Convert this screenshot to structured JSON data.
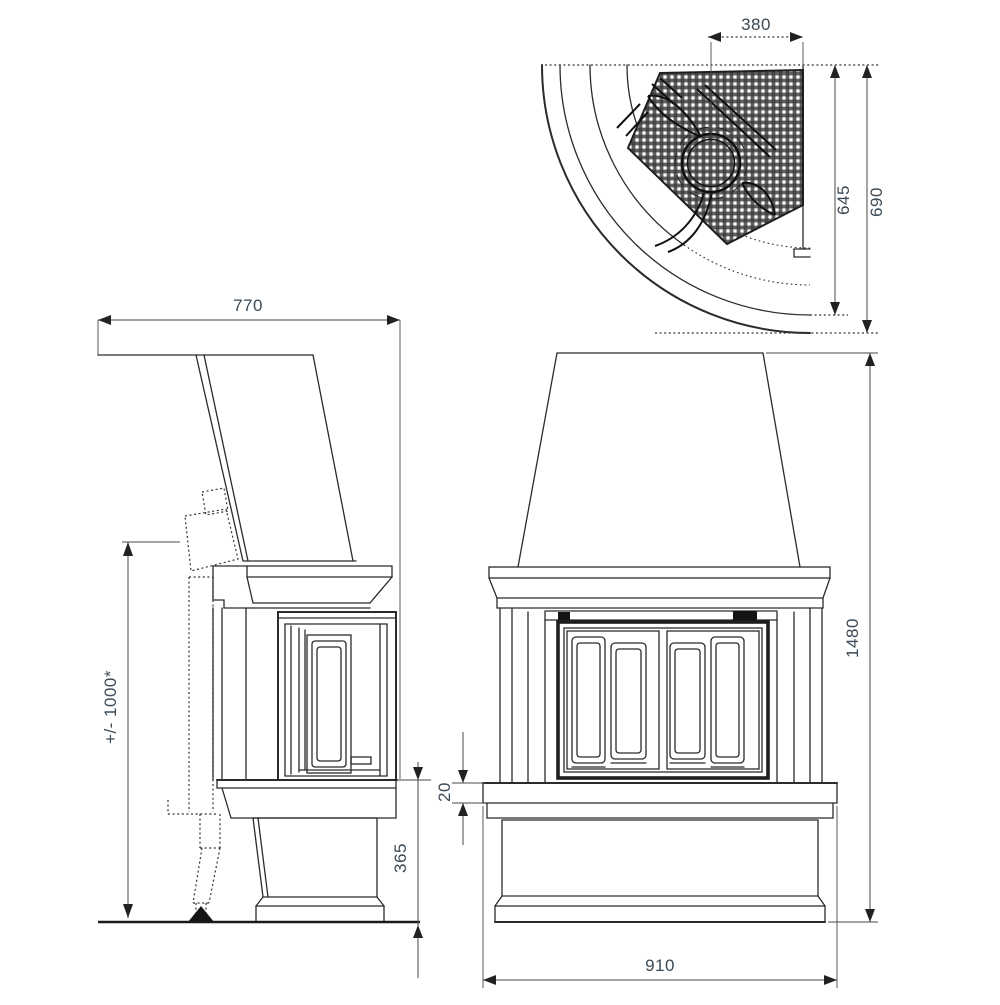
{
  "drawing": {
    "kind": "fireplace-three-view-technical-drawing",
    "views": [
      {
        "id": "top",
        "name": "plan view (curved front, flue section hatched)"
      },
      {
        "id": "side",
        "name": "side elevation"
      },
      {
        "id": "front",
        "name": "front elevation"
      }
    ]
  },
  "dims": {
    "flue_width": {
      "value": "380"
    },
    "depth_inner_face": {
      "value": "645"
    },
    "depth_outer_face": {
      "value": "690"
    },
    "side_depth": {
      "value": "770"
    },
    "install_height": {
      "value": "+/- 1000*"
    },
    "hearth_thickness": {
      "value": "20"
    },
    "base_height": {
      "value": "365"
    },
    "total_height": {
      "value": "1480"
    },
    "front_width": {
      "value": "910"
    }
  },
  "colors": {
    "background": "#ffffff",
    "line": "#2b2b2b",
    "dim_text": "#3b4a56",
    "hatch": "#3d3d3d"
  }
}
